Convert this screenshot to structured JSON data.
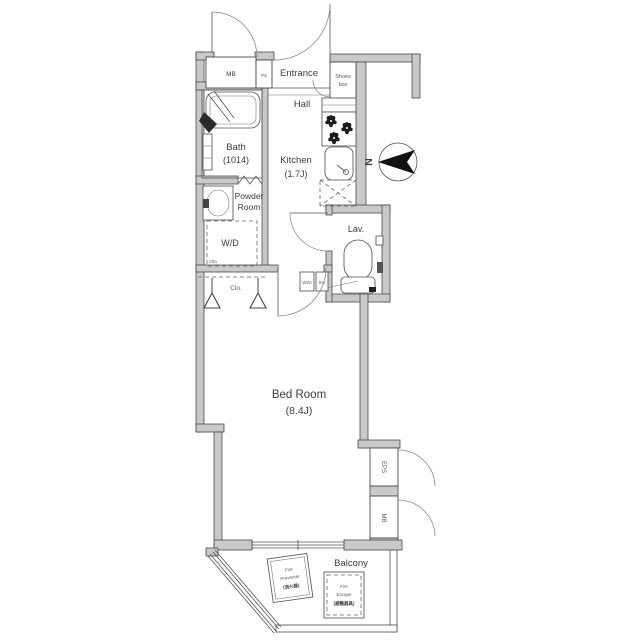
{
  "colors": {
    "wall_fill": "#c9c9c9",
    "wall_stroke": "#4a4a4a",
    "line": "#555555",
    "dark": "#1d1d1d",
    "text": "#3d3d3d"
  },
  "rooms": {
    "entrance": {
      "label": "Entrance"
    },
    "hall": {
      "label": "Hall"
    },
    "kitchen": {
      "label": "Kitchen",
      "size": "(1.7J)"
    },
    "bath": {
      "label": "Bath",
      "size": "(1014)"
    },
    "powder_room": {
      "line1": "Powder",
      "line2": "Room"
    },
    "washer_dryer": {
      "label": "W/D",
      "sub": "20a"
    },
    "closet": {
      "label": "Clo."
    },
    "lavatory": {
      "label": "Lav."
    },
    "bedroom": {
      "label": "Bed Room",
      "size": "(8.4J)"
    },
    "balcony": {
      "label": "Balcony"
    }
  },
  "fixtures": {
    "meter_box_top": "MB",
    "pipe_space": "PS",
    "shoes_box": {
      "line1": "Shoes",
      "line2": "box"
    },
    "eps_shaft": "EPS",
    "meter_box_right": "MB",
    "fixture_w20": "W20",
    "fixture_5pct": "5%",
    "fire_hatch_1": {
      "line1": "Fire",
      "line2": "Preventer",
      "line3": "(消火器)"
    },
    "fire_hatch_2": {
      "line1": "Fire",
      "line2": "Escape",
      "line3": "(避難器具)"
    }
  },
  "compass": {
    "north": "N"
  }
}
